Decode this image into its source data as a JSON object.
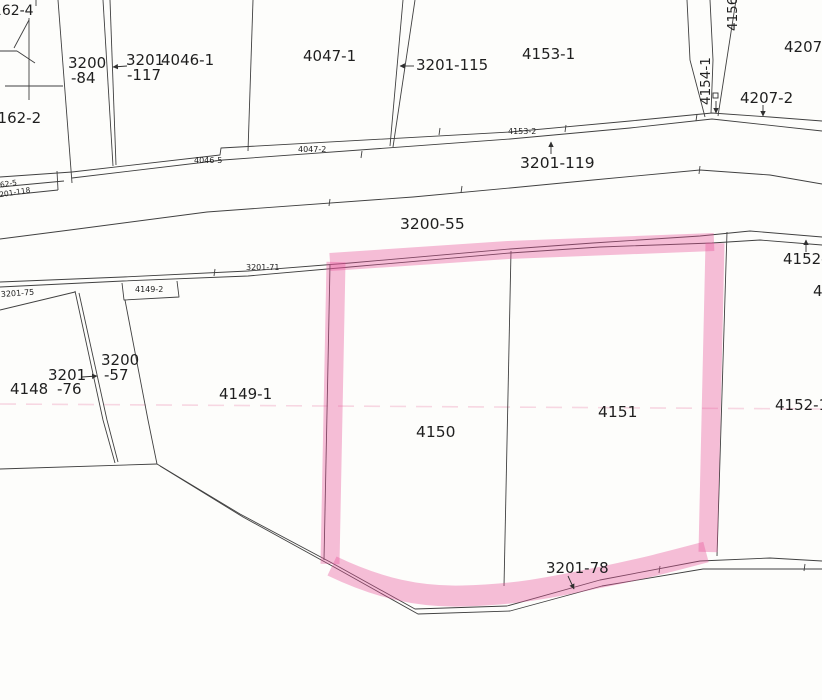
{
  "document": {
    "type": "scanned cadastral parcel map",
    "background": "#fdfdfb"
  },
  "canvas": {
    "width": 822,
    "height": 700
  },
  "colors": {
    "boundary_line": "#404040",
    "text": "#1f1f1f",
    "highlight": "#e8559a",
    "highlight_opacity": 0.38,
    "artifact": "#f0a8c4"
  },
  "highlighted_parcels": [
    "4150",
    "4151"
  ],
  "labels": [
    {
      "id": "4162-4",
      "text": "4162-4",
      "x": -16,
      "y": 15,
      "size": 14
    },
    {
      "id": "4162-2",
      "text": "4162-2",
      "x": -12,
      "y": 123,
      "size": 15
    },
    {
      "id": "3200-84a",
      "text": "3200",
      "x": 68,
      "y": 68,
      "size": 15
    },
    {
      "id": "3200-84b",
      "text": "-84",
      "x": 71,
      "y": 83,
      "size": 15
    },
    {
      "id": "3201-117a",
      "text": "3201",
      "x": 126,
      "y": 65,
      "size": 15
    },
    {
      "id": "3201-117b",
      "text": "-117",
      "x": 127,
      "y": 80,
      "size": 15
    },
    {
      "id": "4046-1",
      "text": "4046-1",
      "x": 161,
      "y": 65,
      "size": 15
    },
    {
      "id": "4047-1",
      "text": "4047-1",
      "x": 303,
      "y": 61,
      "size": 15
    },
    {
      "id": "3201-115",
      "text": "3201-115",
      "x": 416,
      "y": 70,
      "size": 15
    },
    {
      "id": "4153-1",
      "text": "4153-1",
      "x": 522,
      "y": 59,
      "size": 15
    },
    {
      "id": "4154-1",
      "text": "4154-1",
      "x": 710,
      "y": 105,
      "size": 13.5,
      "rot": -90
    },
    {
      "id": "4156",
      "text": "4156",
      "x": 737,
      "y": 31,
      "size": 13.5,
      "rot": -90
    },
    {
      "id": "4207-1",
      "text": "4207-1",
      "x": 784,
      "y": 52,
      "size": 15
    },
    {
      "id": "4207-2",
      "text": "4207-2",
      "x": 740,
      "y": 103,
      "size": 15
    },
    {
      "id": "3201-119",
      "text": "3201-119",
      "x": 520,
      "y": 168,
      "size": 15.5
    },
    {
      "id": "3200-55",
      "text": "3200-55",
      "x": 400,
      "y": 229,
      "size": 15.5
    },
    {
      "id": "3200-57a",
      "text": "3200",
      "x": 101,
      "y": 365,
      "size": 15
    },
    {
      "id": "3200-57b",
      "text": "-57",
      "x": 104,
      "y": 380,
      "size": 15
    },
    {
      "id": "3201-76a",
      "text": "3201",
      "x": 48,
      "y": 380,
      "size": 15
    },
    {
      "id": "3201-76b",
      "text": "-76",
      "x": 57,
      "y": 394,
      "size": 15
    },
    {
      "id": "4148",
      "text": "4148",
      "x": 10,
      "y": 394,
      "size": 15
    },
    {
      "id": "4149-1",
      "text": "4149-1",
      "x": 219,
      "y": 399,
      "size": 15
    },
    {
      "id": "4150",
      "text": "4150",
      "x": 416,
      "y": 437,
      "size": 15.5
    },
    {
      "id": "4151",
      "text": "4151",
      "x": 598,
      "y": 417,
      "size": 15.5
    },
    {
      "id": "4152-1",
      "text": "4152-1",
      "x": 775,
      "y": 410,
      "size": 15
    },
    {
      "id": "4152-2",
      "text": "4152-2",
      "x": 783,
      "y": 264,
      "size": 15
    },
    {
      "id": "4-edge",
      "text": "4",
      "x": 813,
      "y": 296,
      "size": 15
    },
    {
      "id": "3201-78",
      "text": "3201-78",
      "x": 546,
      "y": 573,
      "size": 15
    },
    {
      "id": "4046-5",
      "text": "4046-5",
      "x": 194,
      "y": 163,
      "size": 8
    },
    {
      "id": "4047-2",
      "text": "4047-2",
      "x": 298,
      "y": 152,
      "size": 8
    },
    {
      "id": "4153-2",
      "text": "4153-2",
      "x": 508,
      "y": 134,
      "size": 8
    },
    {
      "id": "3201-71",
      "text": "3201-71",
      "x": 246,
      "y": 270,
      "size": 8
    },
    {
      "id": "3201-75",
      "text": "3201-75",
      "x": 1,
      "y": 297,
      "size": 8,
      "rot": -4
    },
    {
      "id": "4149-2",
      "text": "4149-2",
      "x": 135,
      "y": 292,
      "size": 8
    },
    {
      "id": "4162-5",
      "text": "4162-5",
      "x": -9,
      "y": 189,
      "size": 7.5,
      "rot": -9
    },
    {
      "id": "3201-118",
      "text": "3201-118",
      "x": -5,
      "y": 198,
      "size": 7.5,
      "rot": -9
    }
  ],
  "boundary_lines": [
    {
      "d": "M29,18 L29,100"
    },
    {
      "d": "M29,20 L14,48"
    },
    {
      "d": "M0,51 L17,51"
    },
    {
      "d": "M17,51 L35,63"
    },
    {
      "d": "M5,86 L63,86"
    },
    {
      "d": "M36,0 L36,6"
    },
    {
      "d": "M58,0 L72,183"
    },
    {
      "d": "M103,0 L113,166"
    },
    {
      "d": "M110,0 L116,165"
    },
    {
      "d": "M253,0 L248,151"
    },
    {
      "d": "M403,0 L390,146"
    },
    {
      "d": "M415,0 L393,147"
    },
    {
      "d": "M687,0 L690,60 L705,117"
    },
    {
      "d": "M710,0 L713,60 L711,113"
    },
    {
      "d": "M736,0 L718,116"
    },
    {
      "d": "M0,177 L72,172"
    },
    {
      "d": "M0,187 L64,181"
    },
    {
      "d": "M0,196 L58,190"
    },
    {
      "d": "M57,171 L58,190"
    },
    {
      "d": "M72,172 L220,155 L221,148 L510,132 L630,121 L712,113 L770,117 L822,121"
    },
    {
      "d": "M72,178 L223,160 L510,139 L630,128 L712,119 L822,131"
    },
    {
      "d": "M0,239 L70,230 L207,212 L413,197 L510,188 L593,180 L700,170 L770,175 L822,184"
    },
    {
      "d": "M0,282 L123,277 L248,271 L350,263 L510,249 L593,243 L700,236 L750,231 L822,237"
    },
    {
      "d": "M0,287 L123,281 L248,276 L350,267 L510,253 L600,247 L712,243 L760,240 L822,245"
    },
    {
      "d": "M0,310 L75,292"
    },
    {
      "d": "M75,291 L103,420 L115,463"
    },
    {
      "d": "M79,293 L107,420 L118,462"
    },
    {
      "d": "M125,300 L148,420 L157,464"
    },
    {
      "d": "M177,281 L179,297 L124,300 L122,283"
    },
    {
      "d": "M330,265 L324,560"
    },
    {
      "d": "M511,251 L504,586"
    },
    {
      "d": "M727,232 L717,556"
    },
    {
      "d": "M0,469 L157,464"
    },
    {
      "d": "M157,464 L240,514 L332,563 L415,609 L507,606 L600,580 L700,561 L770,558 L822,561"
    },
    {
      "d": "M160,466 L243,517 L334,567 L418,614 L510,611 L602,586 L703,569 L822,569"
    }
  ],
  "ticks": [
    "M362,151 L361,158",
    "M440,128 L439,135",
    "M566,125 L565,132",
    "M697,114 L696,121",
    "M462,186 L461,193",
    "M700,166 L699,174",
    "M215,269 L214,276",
    "M330,199 L329,206",
    "M660,566 L659,573",
    "M805,564 L804,571"
  ],
  "arrows": [
    {
      "x1": 127,
      "y1": 66,
      "x2": 113,
      "y2": 67
    },
    {
      "x1": 414,
      "y1": 66,
      "x2": 400,
      "y2": 66
    },
    {
      "x1": 551,
      "y1": 154,
      "x2": 551,
      "y2": 142
    },
    {
      "x1": 763,
      "y1": 105,
      "x2": 763,
      "y2": 116
    },
    {
      "x1": 716,
      "y1": 101,
      "x2": 716,
      "y2": 113
    },
    {
      "x1": 806,
      "y1": 252,
      "x2": 806,
      "y2": 240
    },
    {
      "x1": 82,
      "y1": 377,
      "x2": 97,
      "y2": 376
    },
    {
      "x1": 568,
      "y1": 576,
      "x2": 574,
      "y2": 589
    }
  ],
  "marker_square": {
    "x": 713,
    "y": 93,
    "size": 5
  },
  "highlight_segments": [
    {
      "d": "M330,262 L508,250 L714,242",
      "w": 18
    },
    {
      "d": "M715,243 L708,552",
      "w": 19
    },
    {
      "d": "M332,566 C380,589 420,597 462,596 C520,595 562,585 602,577 C642,569 672,561 706,552",
      "w": 21
    },
    {
      "d": "M336,262 L330,564",
      "w": 19
    }
  ],
  "artifact_line": {
    "d": "M0,404 L822,409",
    "dash": "16 10"
  }
}
